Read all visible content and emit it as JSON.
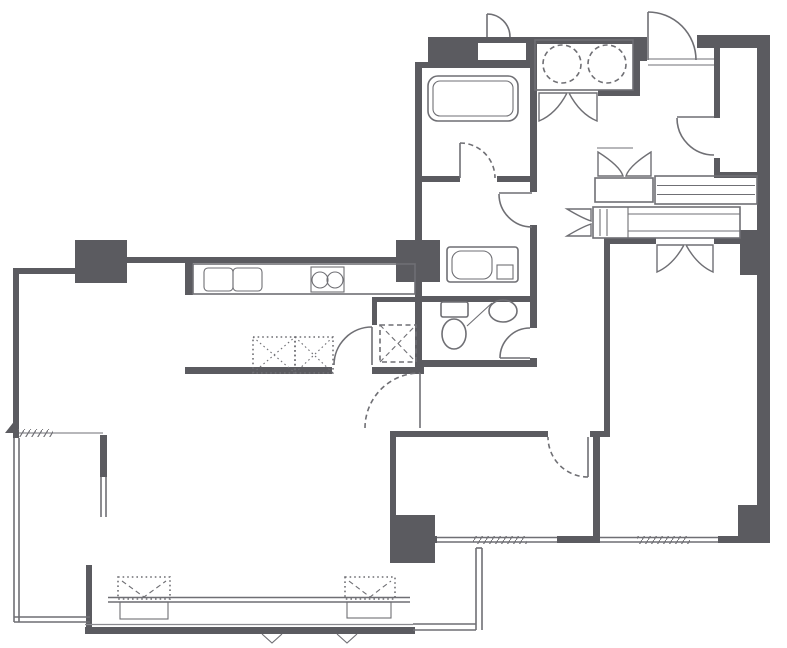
{
  "diagram": {
    "kind": "apartment-floor-plan",
    "style": "architectural line drawing, top view",
    "text_labels_visible": false
  },
  "colors": {
    "wall": "#5b5b60",
    "line": "#6f6f74",
    "thin": "#8a8a8f",
    "background": "#ffffff"
  },
  "rooms": [
    {
      "name": "living-dining-kitchen",
      "position": "left-center"
    },
    {
      "name": "bathroom-with-tub",
      "position": "top-left-of-center"
    },
    {
      "name": "laundry-closet-washer-dryer",
      "position": "top-center"
    },
    {
      "name": "lavatory-washroom",
      "position": "center"
    },
    {
      "name": "toilet-room",
      "position": "center"
    },
    {
      "name": "entry-hall",
      "position": "top-right"
    },
    {
      "name": "storage-room",
      "position": "top-right-corner"
    },
    {
      "name": "bedroom-large",
      "position": "right"
    },
    {
      "name": "bedroom-small",
      "position": "bottom-center"
    },
    {
      "name": "balcony-l-shaped",
      "position": "bottom-and-left"
    }
  ],
  "fixtures": [
    "bathtub",
    "washer-dryer-circles",
    "kitchen-double-sink",
    "gas-stove-two-burners",
    "kitchen-island-dashed",
    "refrigerator-space-dashed-x",
    "wash-basin-vanity",
    "toilet",
    "toilet-corner-basin",
    "shoe-closet-shelves",
    "wardrobe-band",
    "bifold-closet-doors",
    "swing-doors",
    "entry-door",
    "window-hatches",
    "balcony-railing",
    "structural-pillars"
  ]
}
